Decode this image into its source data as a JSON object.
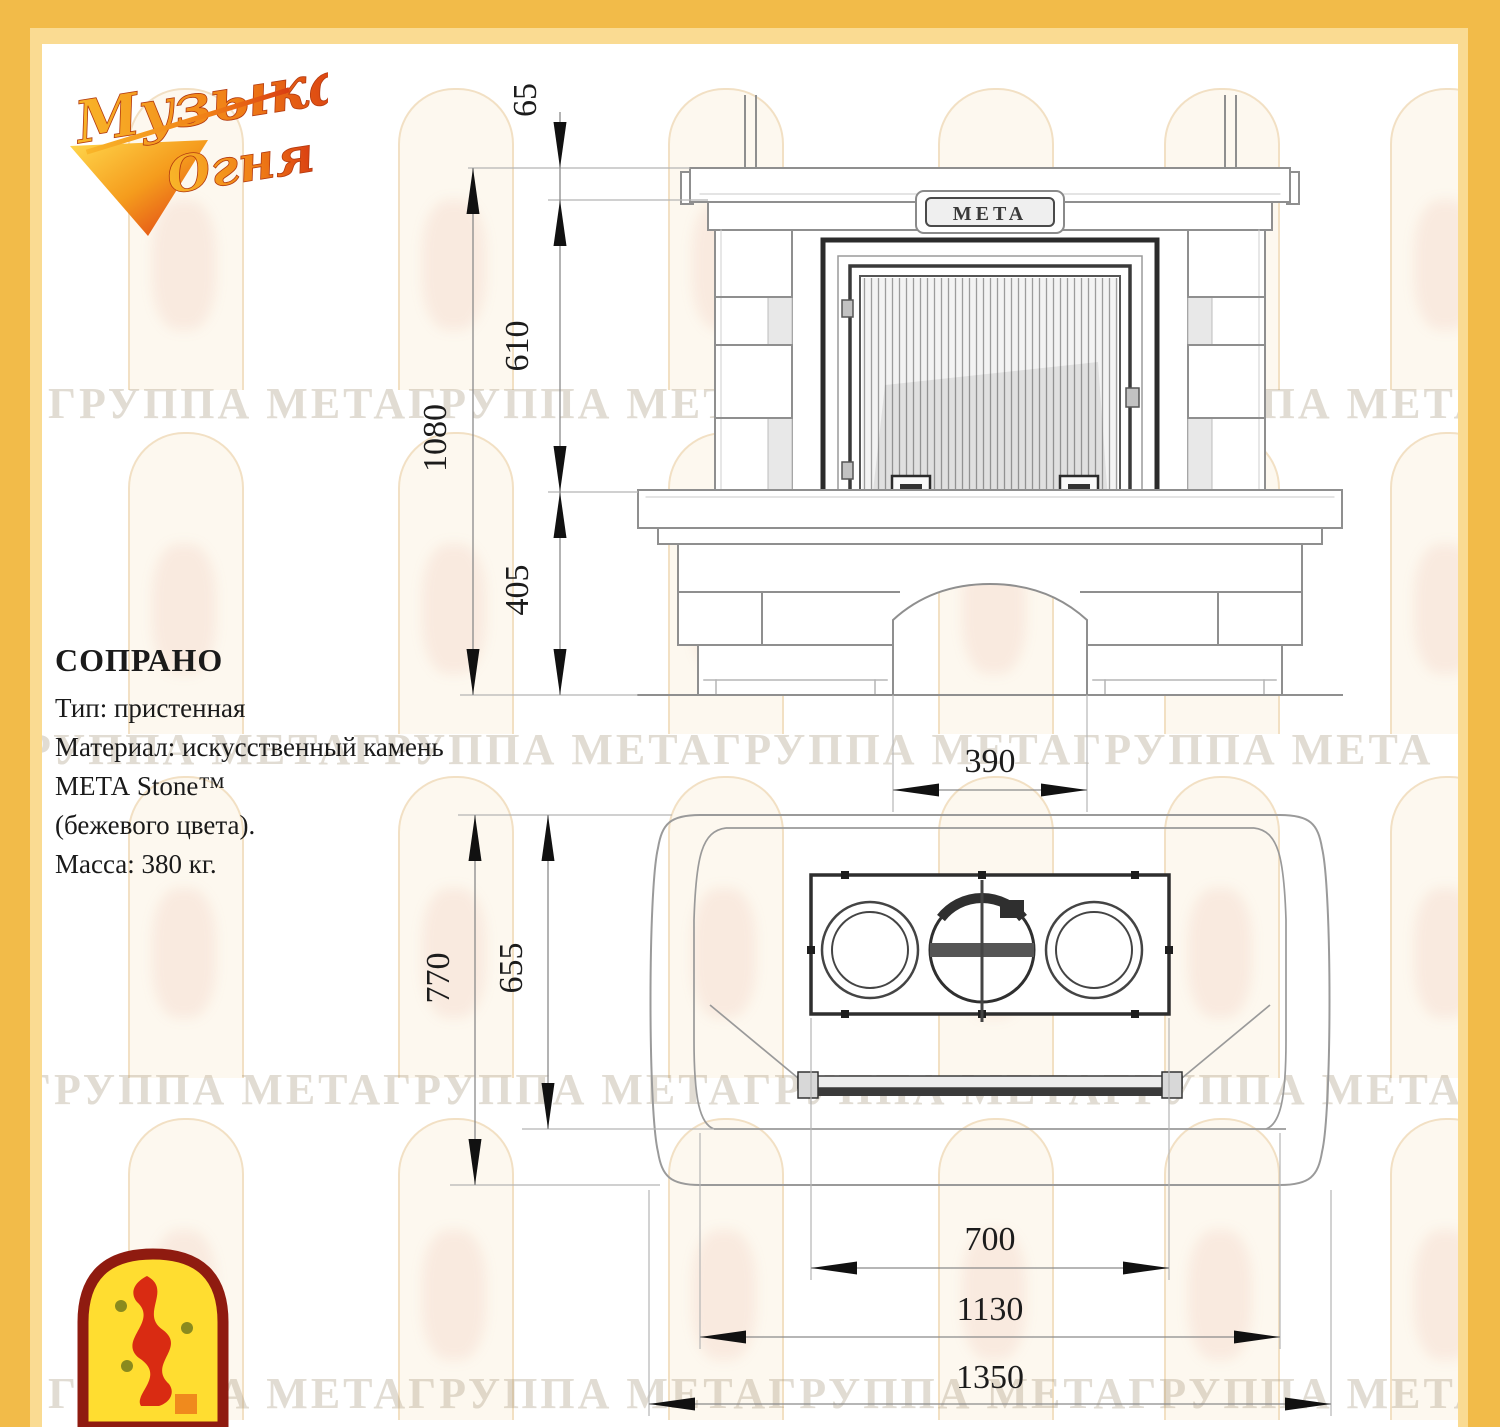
{
  "page": {
    "border_gold": "#f2bb49",
    "border_gold_light": "#fadb92",
    "watermark_text": "ГРУППА МЕТАГРУППА МЕТАГРУППА МЕТАГРУППА МЕТА"
  },
  "brand": {
    "logo_line1": "Музыка",
    "logo_line2": "Огня"
  },
  "info": {
    "title": "СОПРАНО",
    "lines": [
      "Тип: пристенная",
      "Материал: искусственный камень",
      "МЕТА Stone™",
      "(бежевого цвета).",
      "Масса: 380 кг."
    ]
  },
  "front_view": {
    "plate_label": "META",
    "dim_65": "65",
    "dim_610": "610",
    "dim_1080": "1080",
    "dim_405": "405",
    "dim_390": "390"
  },
  "top_view": {
    "dim_770": "770",
    "dim_655": "655",
    "dim_700": "700",
    "dim_1130": "1130",
    "dim_1350": "1350"
  }
}
